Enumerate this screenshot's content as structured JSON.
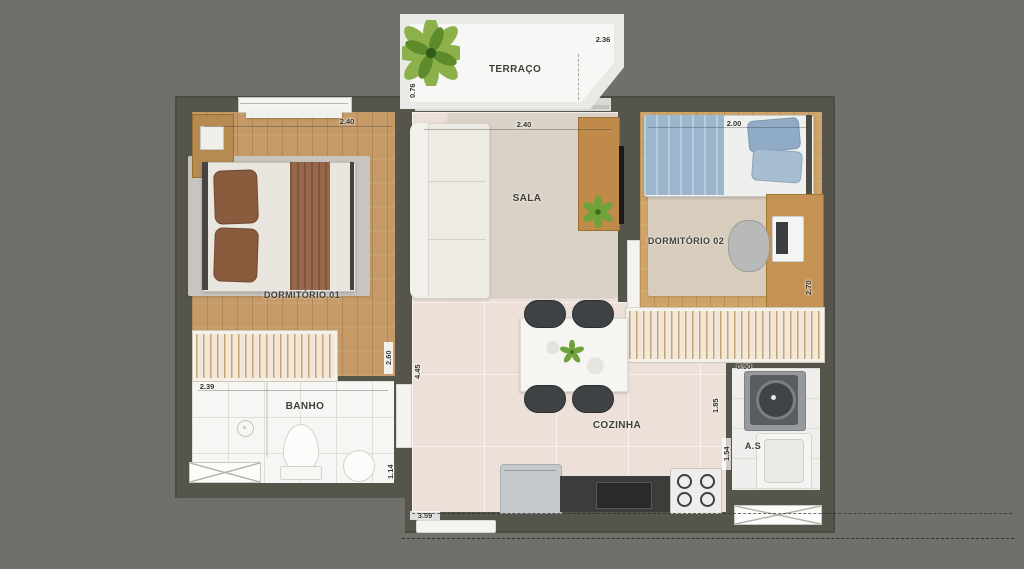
{
  "plan": {
    "title": "floor-plan",
    "terraco": {
      "label": "TERRAÇO",
      "dim_width": "2.36",
      "dim_depth": "0.76"
    },
    "dormitorio_01": {
      "label": "DORMITÓRIO 01",
      "dim_width": "2.40"
    },
    "sala": {
      "label": "SALA",
      "dim_width": "2.40"
    },
    "dormitorio_02": {
      "label": "DORMITÓRIO 02",
      "dim_width": "2.00",
      "dim_depth": "2.70"
    },
    "banho": {
      "label": "BANHO",
      "dim_width": "2.39",
      "dim_depth": "1.14"
    },
    "cozinha": {
      "label": "COZINHA",
      "dim_bottom": "3.59",
      "dim_depth": "4.45",
      "dim_wall": "2.60"
    },
    "area_servico": {
      "label": "A.S",
      "dim_width": "0.90",
      "dim_depth_upper": "1.85",
      "dim_depth_lower": "1.54"
    }
  },
  "colors": {
    "background": "#706f6a",
    "wall": "#56554c",
    "wood_floor": "#c59a66",
    "pale_floor": "#ece0d8",
    "bed_blue": "#9cb6ce",
    "pillow_brown": "#8a5b3d",
    "plant_green": "#6fa339",
    "counter_dark": "#3c3c3a"
  }
}
